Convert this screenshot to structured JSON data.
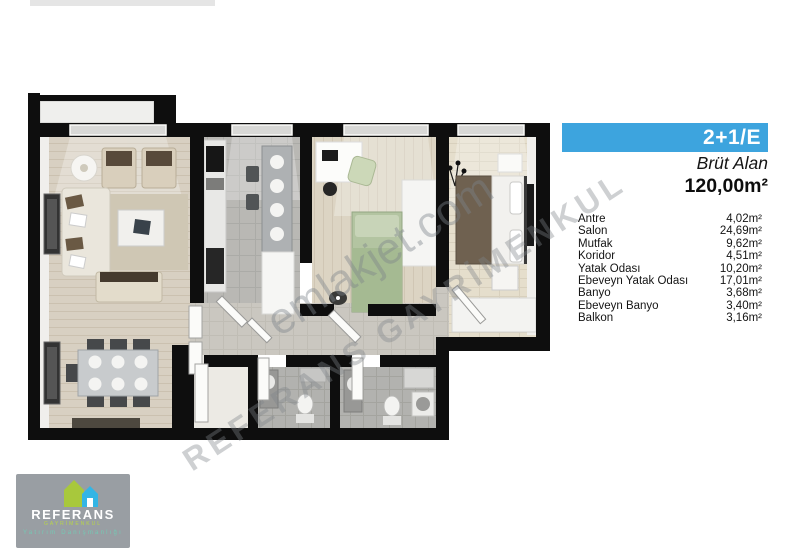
{
  "header": {
    "unit_type": "2+1/E",
    "gross_area_label": "Brüt Alan",
    "gross_area_value": "120,00m²",
    "bar_color": "#3da4de"
  },
  "area_table": {
    "rows": [
      {
        "label": "Antre",
        "value": "4,02m²"
      },
      {
        "label": "Salon",
        "value": "24,69m²"
      },
      {
        "label": "Mutfak",
        "value": "9,62m²"
      },
      {
        "label": "Koridor",
        "value": "4,51m²"
      },
      {
        "label": "Yatak Odası",
        "value": "10,20m²"
      },
      {
        "label": "Ebeveyn Yatak Odası",
        "value": "17,01m²"
      },
      {
        "label": "Banyo",
        "value": "3,68m²"
      },
      {
        "label": "Ebeveyn Banyo",
        "value": "3,40m²"
      },
      {
        "label": "Balkon",
        "value": "3,16m²"
      }
    ]
  },
  "watermarks": {
    "primary": "emlakjet.com",
    "secondary": "REFERANS GAYRİMENKUL"
  },
  "logo": {
    "name": "REFERANS",
    "subtitle": "GAYRİMENKUL",
    "tagline": "Yatırım Danışmanlığı",
    "green": "#a8c83c",
    "blue": "#33b5e5",
    "box_color": "#999ea3"
  },
  "floor_plan": {
    "type": "top-down apartment render",
    "wall_color": "#0e0e0e",
    "rooms_depicted": [
      "Balkon",
      "Salon",
      "Mutfak",
      "Yatak Odası",
      "Ebeveyn Yatak Odası",
      "Koridor",
      "Antre",
      "Banyo",
      "Ebeveyn Banyo"
    ]
  }
}
